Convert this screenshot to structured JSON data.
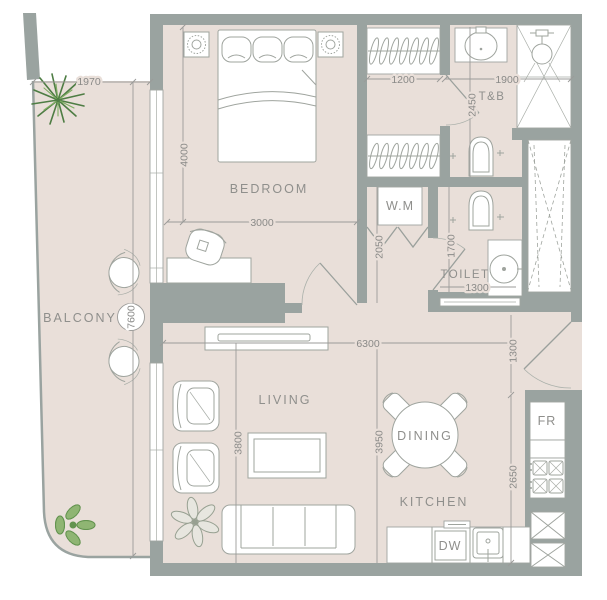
{
  "title": "apartment-floor-plan",
  "rooms": {
    "balcony": "BALCONY",
    "bedroom": "BEDROOM",
    "living": "LIVING",
    "dining": "DINING",
    "kitchen": "KITCHEN",
    "toilet": "TOILET",
    "tandb": "T&B"
  },
  "appliances": {
    "washing_machine": "W.M",
    "fridge": "FR",
    "dishwasher": "DW"
  },
  "dimensions": {
    "balcony_width": "1970",
    "balcony_length": "7600",
    "bedroom_depth": "4000",
    "bedroom_width": "3000",
    "closet_width": "1200",
    "tandb_width": "1900",
    "tandb_depth": "2450",
    "hall_depth": "2050",
    "toilet_depth": "1700",
    "toilet_width": "1300",
    "living_span": "6300",
    "entry_width": "1300",
    "living_depth": "3800",
    "dining_depth": "3950",
    "kitchen_depth": "2650"
  },
  "colors": {
    "floor": "#e9dfd9",
    "wall": "#9aa3a0",
    "furniture_line": "#9fa49e",
    "dimension_text": "#8a8a88",
    "label_text": "#8f8f8c",
    "plant_dark_green": "#4e7d44",
    "plant_light_green": "#8fb573"
  }
}
